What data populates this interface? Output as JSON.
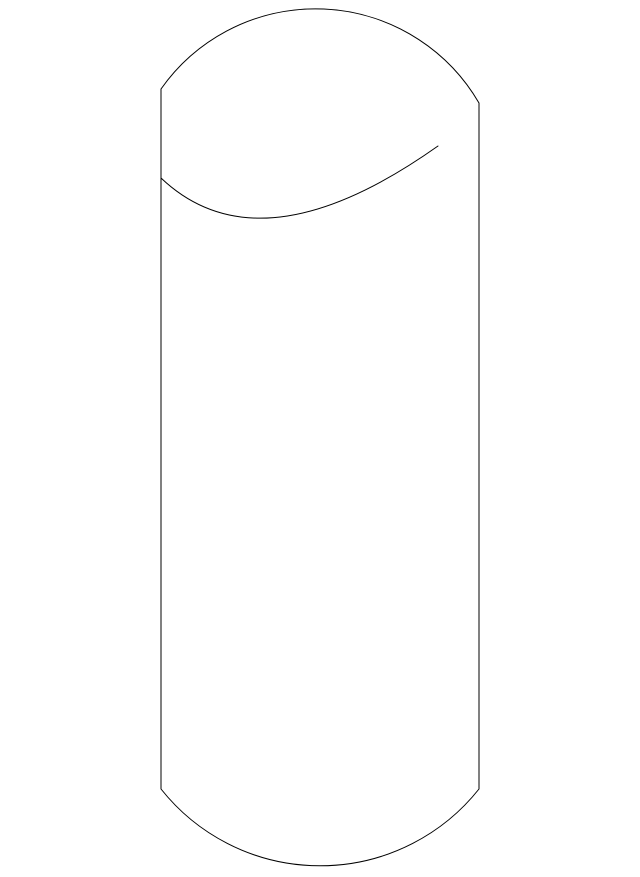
{
  "figure": {
    "description": "Outline line drawing of a vertical cylindrical part with a domed (rounded) top and rounded bottom end",
    "paths": {
      "outline": "M 161 89 A 189 189 0 0 1 479 103 L 479 789 A 203 203 0 0 1 161 789 Z",
      "dome_edge": "M 161 178 Q 260 272 438 146"
    }
  },
  "colors": {
    "line": "#000000",
    "background": "#ffffff"
  }
}
